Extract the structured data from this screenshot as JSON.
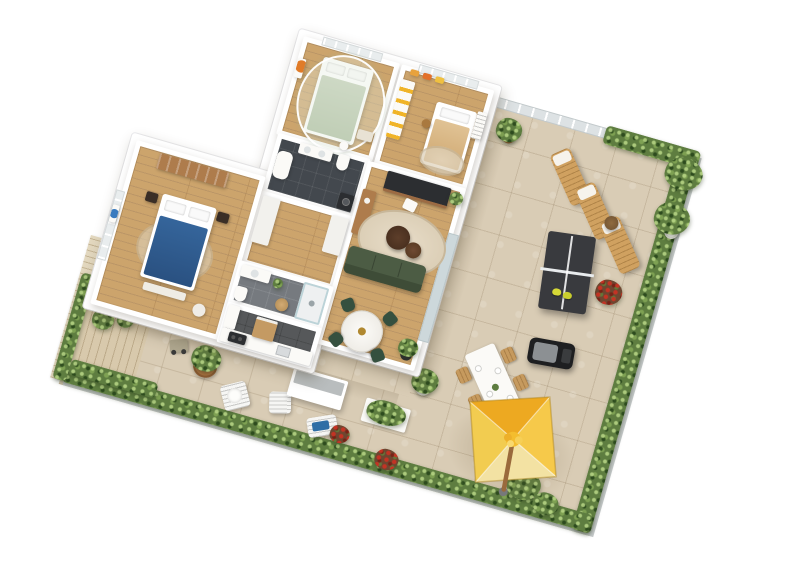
{
  "scene": {
    "label": "3d-apartment-floorplan-render-with-terrace",
    "background": "#ffffff",
    "rotation_deg": 16,
    "palette": {
      "wall_white": "#ffffff",
      "wood_floor": "#cca46c",
      "terrace_tile": "#d9ccb5",
      "deck_wood": "#d8c9ac",
      "bath_dark_floor": "#43484e",
      "bath_gray_floor": "#767a7f",
      "kitchen_floor": "#56585a",
      "hedge_green": "#5e7d40",
      "sofa_green": "#4c5c44",
      "bed_navy": "#2f5b8d",
      "bed_sage": "#bac7ae",
      "bed_beige": "#d9b987",
      "lounger_wood": "#d0a160",
      "pingpong_top": "#393a3e",
      "paddle_yellow": "#d6d937",
      "umbrella_nw": "#eda921",
      "umbrella_ne": "#f6c94a",
      "umbrella_se": "#f3e2a3",
      "umbrella_sw": "#f2cc50",
      "accent_orange": "#e07b28",
      "flower_red": "#bb3a2b",
      "art_blue": "#3a7bbf"
    },
    "apartment": {
      "label": "apartment-interior",
      "rooms": [
        {
          "name": "bedroom-canopy",
          "floor": "wood",
          "furniture": [
            "canopy-bed-sage",
            "sheer-canopy",
            "orange-wall-art",
            "bench",
            "stool"
          ]
        },
        {
          "name": "kids-bedroom",
          "floor": "wood",
          "furniture": [
            "single-bed-beige",
            "teddy-bear",
            "crib",
            "wardrobe-yellow",
            "wall-pictures",
            "rug"
          ]
        },
        {
          "name": "bathroom-main",
          "floor": "dark-tile",
          "furniture": [
            "bathtub",
            "sink-counter",
            "toilet",
            "washing-machine"
          ]
        },
        {
          "name": "hallway",
          "floor": "wood",
          "furniture": [
            "closet-west",
            "closet-east"
          ]
        },
        {
          "name": "living-room",
          "floor": "wood",
          "furniture": [
            "desk-dark",
            "desk-chair",
            "sideboard-wood",
            "round-rug",
            "coffee-table-large",
            "coffee-table-small",
            "sofa-green",
            "round-dining-table",
            "dining-chairs-green",
            "potted-plant"
          ]
        },
        {
          "name": "master-bedroom",
          "floor": "wood",
          "furniture": [
            "double-bed-navy",
            "bookshelf-wood",
            "nightstands",
            "blue-round-wall-art",
            "bed-bench",
            "pouf",
            "rug"
          ]
        },
        {
          "name": "bathroom-shower",
          "floor": "gray-tile",
          "furniture": [
            "walk-in-shower",
            "sink-counter",
            "toilet",
            "laundry-basket",
            "plant"
          ]
        },
        {
          "name": "kitchen",
          "floor": "dark-tile",
          "furniture": [
            "counter-run",
            "cooktop-dark",
            "sink",
            "island-wood",
            "tall-cabinet"
          ]
        }
      ]
    },
    "terrace": {
      "label": "wrap-around-terrace",
      "floor": "beige-stone-tiles",
      "features": [
        "glass-railing-north",
        "hedge-north",
        "hedge-east",
        "hedge-south",
        "hedge-west",
        "privacy-screen-wood",
        "wood-deck"
      ],
      "items": [
        {
          "name": "sun-lounger",
          "count": 3
        },
        {
          "name": "wicker-side-table",
          "count": 1
        },
        {
          "name": "ping-pong-table",
          "count": 1
        },
        {
          "name": "ping-pong-paddle-yellow",
          "count": 2
        },
        {
          "name": "bbq-grill",
          "count": 1
        },
        {
          "name": "outdoor-dining-table",
          "count": 1
        },
        {
          "name": "outdoor-dining-chair",
          "count": 6
        },
        {
          "name": "yellow-parasol",
          "count": 1
        },
        {
          "name": "white-slat-chair",
          "count": 2
        },
        {
          "name": "white-slat-bench-blue-towel",
          "count": 1
        },
        {
          "name": "garden-cart",
          "count": 1
        },
        {
          "name": "planter-box",
          "count": 2
        },
        {
          "name": "potted-plant",
          "count": 9
        },
        {
          "name": "red-flower-plant",
          "count": 4
        },
        {
          "name": "terrace-storage-bench",
          "count": 1
        }
      ]
    }
  }
}
